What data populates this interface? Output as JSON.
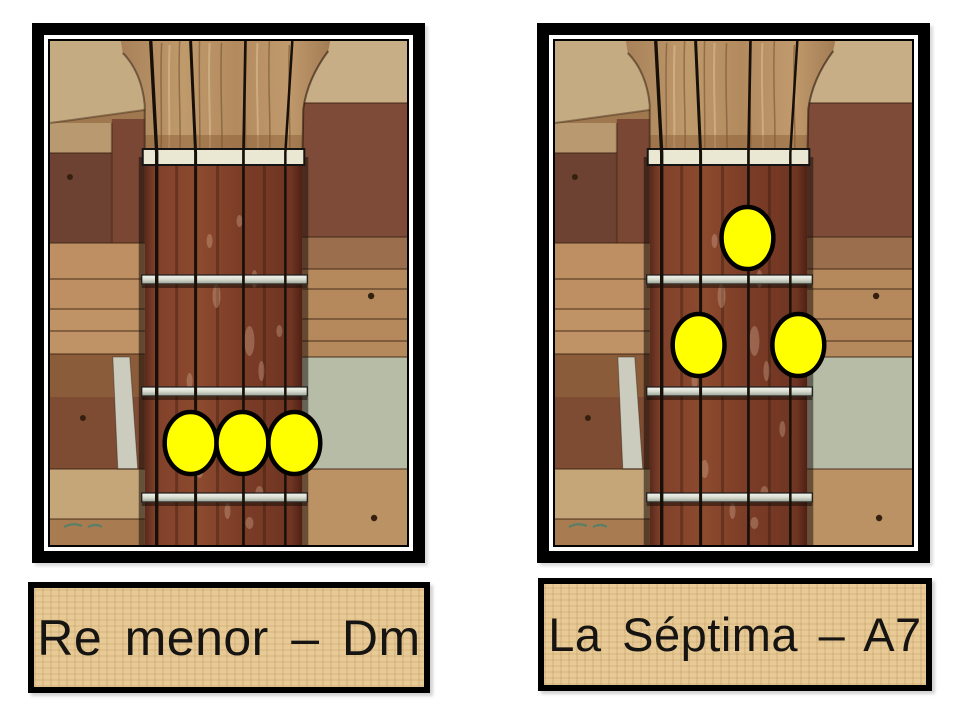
{
  "page": {
    "background_color": "#ffffff",
    "description": "Chord chart with two photographed fretboard diagrams of a four-string instrument"
  },
  "instrument": {
    "strings": 4,
    "fret_spaces_visible": 3,
    "dot_color": "#ffff00",
    "dot_outline_color": "#000000"
  },
  "panels": [
    {
      "id": "dm",
      "label": "Re menor – Dm",
      "chord_name": "Re menor",
      "chord_symbol": "Dm",
      "finger_dots": [
        {
          "string": 2,
          "fret_space": 3,
          "cx": 141,
          "cy": 402
        },
        {
          "string": 3,
          "fret_space": 3,
          "cx": 193,
          "cy": 402
        },
        {
          "string": 4,
          "fret_space": 3,
          "cx": 245,
          "cy": 402
        }
      ]
    },
    {
      "id": "a7",
      "label": "La Séptima – A7",
      "chord_name": "La Séptima",
      "chord_symbol": "A7",
      "finger_dots": [
        {
          "string": 3,
          "fret_space": 1,
          "cx": 193,
          "cy": 197
        },
        {
          "string": 2,
          "fret_space": 2,
          "cx": 144,
          "cy": 304
        },
        {
          "string": 4,
          "fret_space": 2,
          "cx": 244,
          "cy": 304
        }
      ]
    }
  ],
  "colors": {
    "frame_border": "#000000",
    "label_background": "#e8ca96",
    "label_text": "#161412",
    "fretboard": "#7c3d27",
    "fret_wire": "#d6dacf",
    "nut": "#eae8d3"
  }
}
